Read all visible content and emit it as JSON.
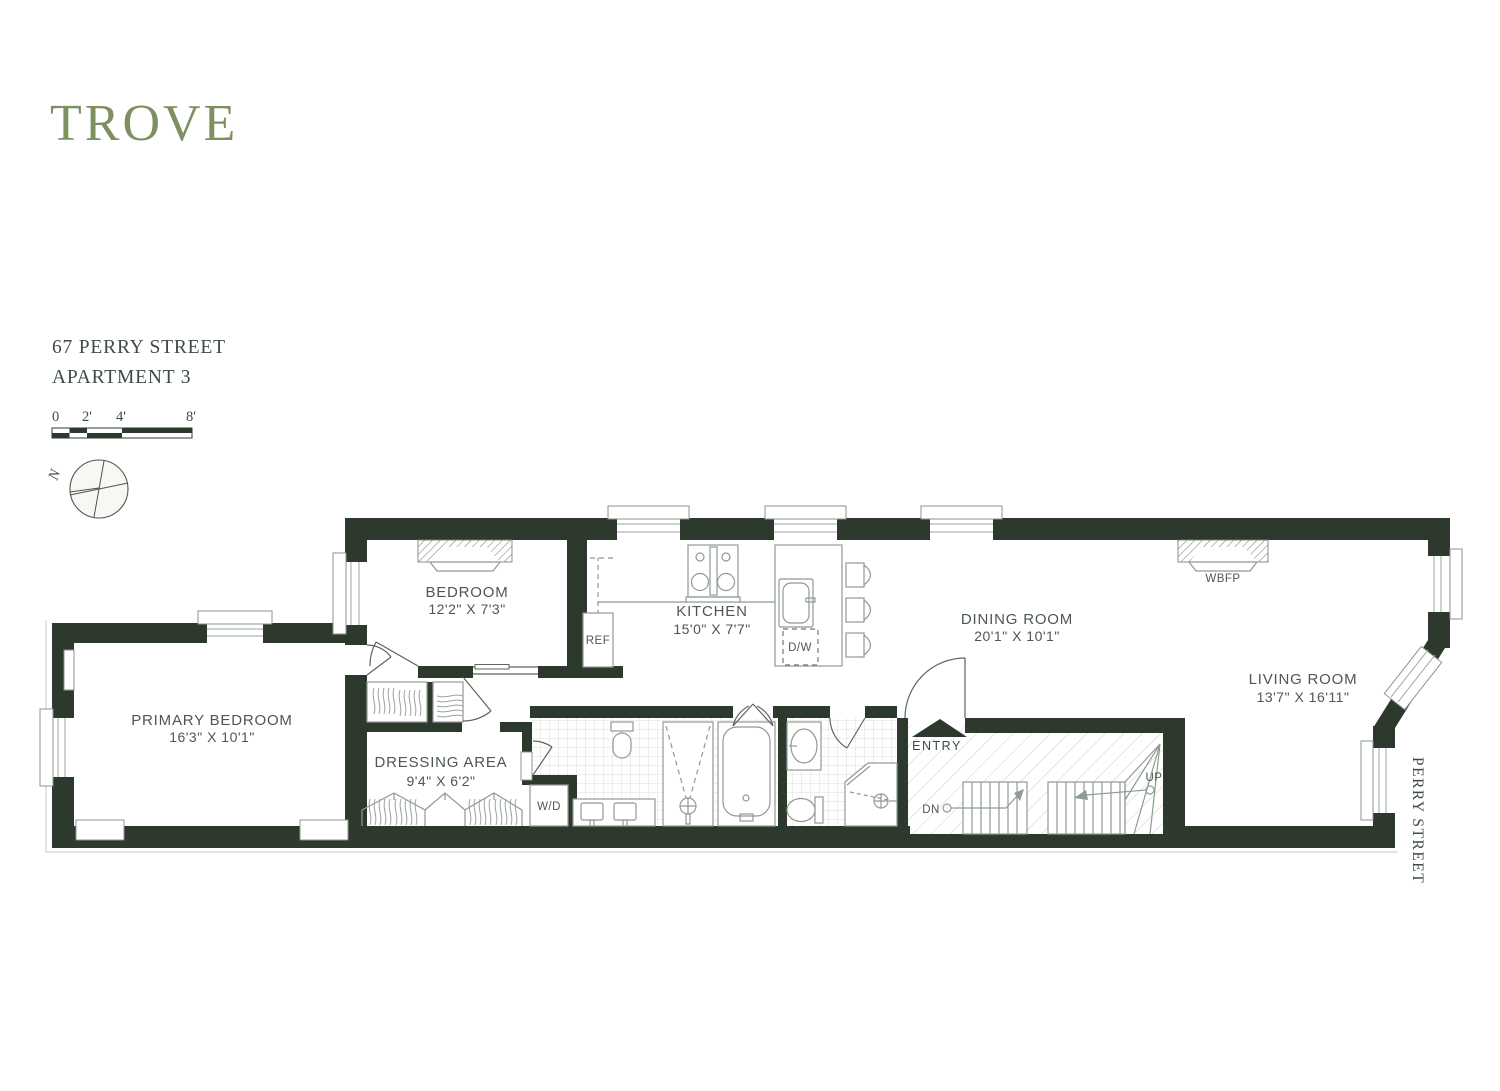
{
  "brand": {
    "logo": "TROVE"
  },
  "listing": {
    "address_line1": "67 PERRY STREET",
    "address_line2": "APARTMENT 3"
  },
  "scale_bar": {
    "labels": [
      "0",
      "2'",
      "4'",
      "8'"
    ]
  },
  "compass": {
    "north_label": "N"
  },
  "street_label": "PERRY STREET",
  "rooms": {
    "bedroom": {
      "name": "BEDROOM",
      "dims": "12'2\" X 7'3\""
    },
    "kitchen": {
      "name": "KITCHEN",
      "dims": "15'0\" X 7'7\""
    },
    "dining_room": {
      "name": "DINING ROOM",
      "dims": "20'1\" X 10'1\""
    },
    "living_room": {
      "name": "LIVING ROOM",
      "dims": "13'7\" X 16'11\""
    },
    "primary_bedroom": {
      "name": "PRIMARY BEDROOM",
      "dims": "16'3\" X 10'1\""
    },
    "dressing_area": {
      "name": "DRESSING AREA",
      "dims": "9'4\" X 6'2\""
    }
  },
  "fixtures": {
    "fireplace": "WBFP",
    "refrigerator": "REF",
    "dishwasher": "D/W",
    "washer_dryer": "W/D",
    "entry": "ENTRY",
    "stairs_up": "UP",
    "stairs_down": "DN"
  },
  "colors": {
    "wall": "#2d392d",
    "brand_green": "#7e9060",
    "label_text": "#4d584f",
    "fixture_line": "#8f9a92"
  }
}
